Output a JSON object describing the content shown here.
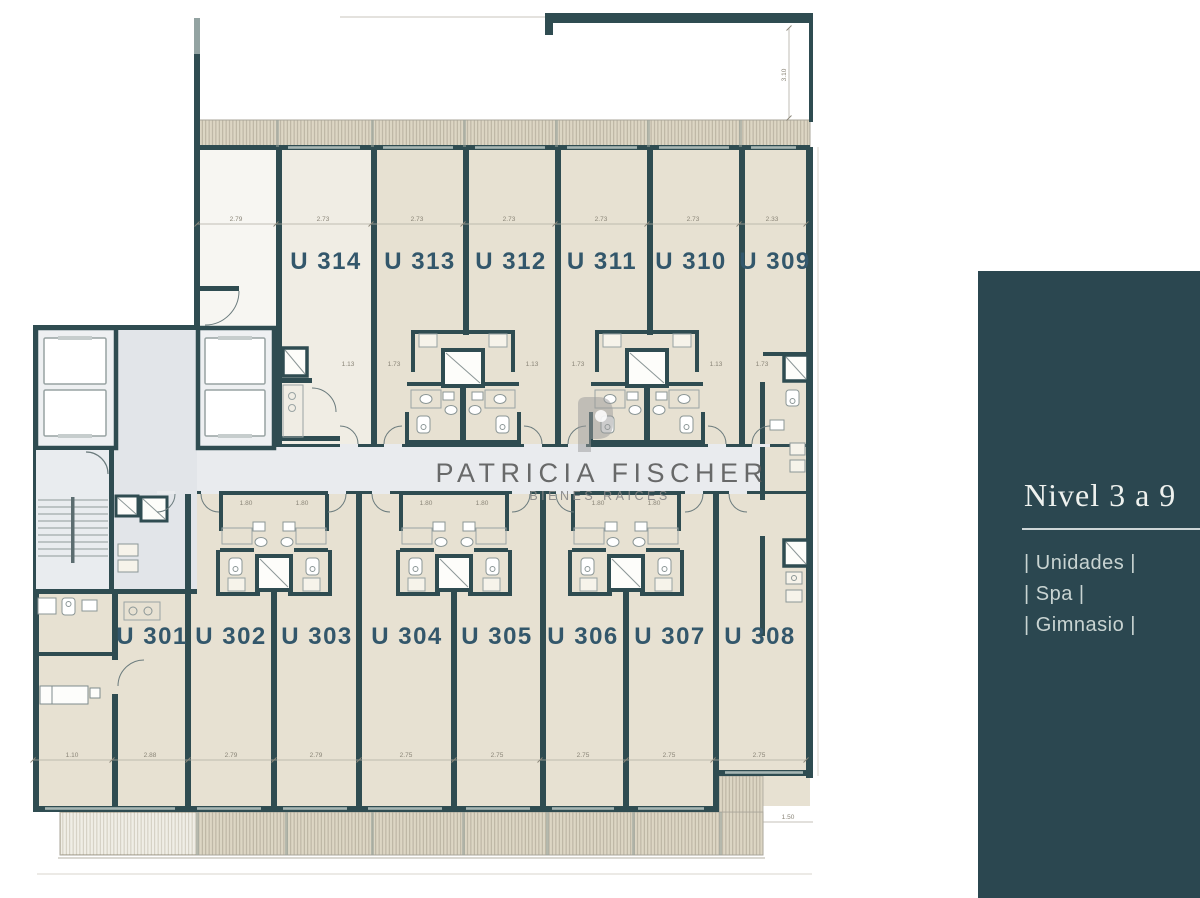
{
  "brand": {
    "name": "PATRICIA FISCHER",
    "tagline": "BIENES RAICES",
    "monogram_icon": "pf-monogram"
  },
  "panel": {
    "title": "Nivel 3 a 9",
    "items": [
      "| Unidades |",
      "| Spa |",
      "| Gimnasio |"
    ]
  },
  "plan": {
    "units_top": [
      "U 314",
      "U 313",
      "U 312",
      "U 311",
      "U 310",
      "U 309"
    ],
    "units_bottom": [
      "U 301",
      "U 302",
      "U 303",
      "U 304",
      "U 305",
      "U 306",
      "U 307",
      "U 308"
    ],
    "dims_top": [
      "2.79",
      "2.73",
      "2.73",
      "2.73",
      "2.73",
      "2.73",
      "2.33"
    ],
    "dims_bottom": [
      "1.10",
      "2.88",
      "2.79",
      "2.79",
      "2.75",
      "2.75",
      "2.75",
      "2.75",
      "2.75"
    ],
    "dims_side": [
      "3.10",
      "1.50"
    ],
    "dims_mid": [
      "1.13",
      "1.73",
      "1.13",
      "1.73",
      "1.13",
      "1.73"
    ],
    "dims_inner": [
      "1.80",
      "1.80",
      "1.80",
      "1.80",
      "1.80",
      "1.80"
    ]
  },
  "colors": {
    "wall": "#2f4c51",
    "unit_fill": "#e7e1d2",
    "unit_fill_light": "#f0ede4",
    "corridor": "#e2e5e9",
    "balcony": "#ddd6c4",
    "hatch_line": "#b3ac9b",
    "panel_bg": "#2b4750",
    "unit_label": "#33576b",
    "watermark": "#5e5e5e"
  }
}
